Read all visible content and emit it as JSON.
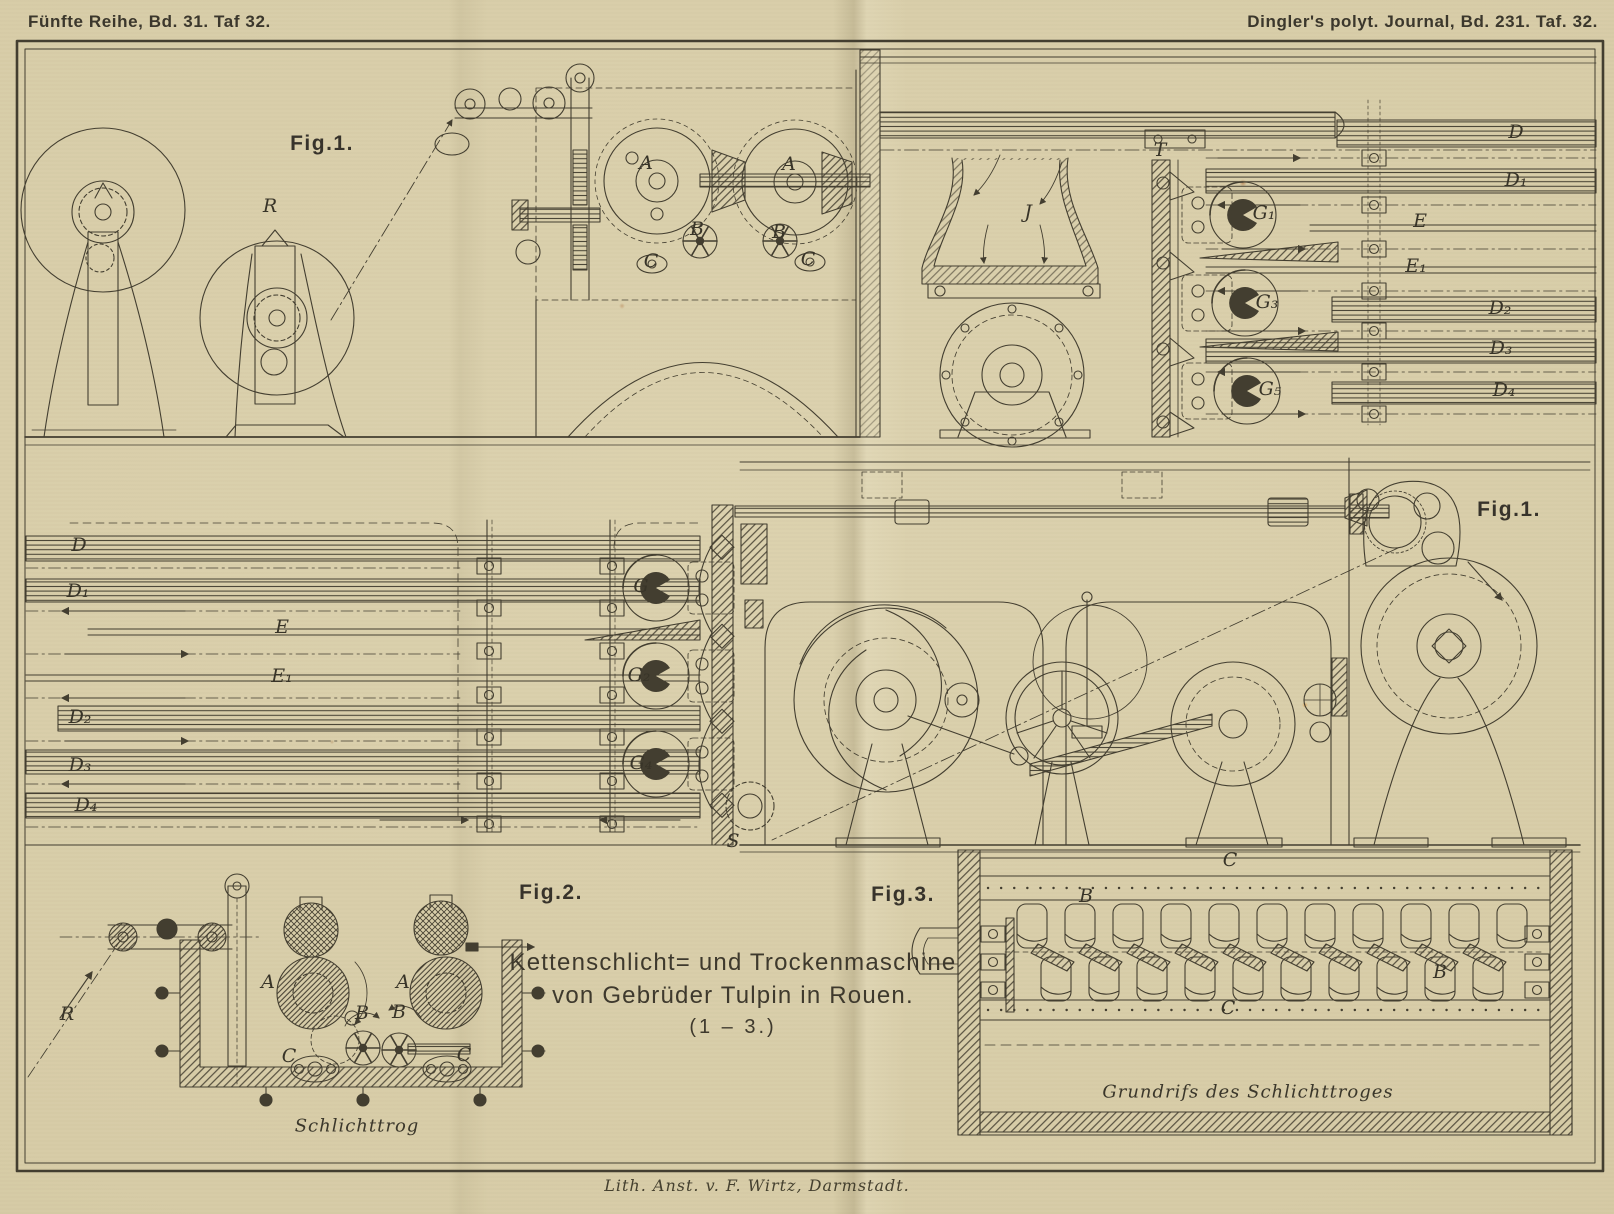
{
  "plate": {
    "header_left": "Fünfte Reihe, Bd. 31. Taf 32.",
    "header_right": "Dingler's polyt. Journal, Bd. 231. Taf. 32.",
    "footer": "Lith. Anst. v. F. Wirtz, Darmstadt.",
    "title": {
      "line1": "Kettenschlicht= und Trockenmaschine",
      "line2": "von Gebrüder Tulpin in Rouen.",
      "range": "(1 – 3.)"
    },
    "colors": {
      "paper": "#d7cca7",
      "paper_light": "#dcd2af",
      "paper_dark": "#cec29b",
      "ink": "#433e30",
      "ink_dark": "#37332b",
      "hatch": "#4a4435"
    }
  },
  "figure_labels": [
    {
      "text": "Fig.1.",
      "x": 322,
      "y": 144
    },
    {
      "text": "Fig.1.",
      "x": 1509,
      "y": 510
    },
    {
      "text": "Fig.2.",
      "x": 551,
      "y": 893
    },
    {
      "text": "Fig.3.",
      "x": 903,
      "y": 895
    }
  ],
  "captions": [
    {
      "text": "Schlichttrog",
      "x": 357,
      "y": 1126
    },
    {
      "text": "Grundrifs des Schlichttroges",
      "x": 1248,
      "y": 1092
    }
  ],
  "part_labels": [
    {
      "text": "R",
      "x": 270,
      "y": 206
    },
    {
      "text": "A",
      "x": 646,
      "y": 163
    },
    {
      "text": "A",
      "x": 789,
      "y": 164
    },
    {
      "text": "B",
      "x": 697,
      "y": 229
    },
    {
      "text": "B",
      "x": 779,
      "y": 232
    },
    {
      "text": "C",
      "x": 651,
      "y": 261
    },
    {
      "text": "C",
      "x": 808,
      "y": 259
    },
    {
      "text": "J",
      "x": 1028,
      "y": 212
    },
    {
      "text": "T",
      "x": 1160,
      "y": 150
    },
    {
      "text": "G₁",
      "x": 1264,
      "y": 213
    },
    {
      "text": "G₃",
      "x": 1267,
      "y": 302
    },
    {
      "text": "G₅",
      "x": 1270,
      "y": 389
    },
    {
      "text": "D",
      "x": 1516,
      "y": 132
    },
    {
      "text": "D₁",
      "x": 1516,
      "y": 180
    },
    {
      "text": "E",
      "x": 1420,
      "y": 221
    },
    {
      "text": "E₁",
      "x": 1416,
      "y": 266
    },
    {
      "text": "D₂",
      "x": 1500,
      "y": 308
    },
    {
      "text": "D₃",
      "x": 1501,
      "y": 348
    },
    {
      "text": "D₄",
      "x": 1504,
      "y": 390
    },
    {
      "text": "D",
      "x": 79,
      "y": 545
    },
    {
      "text": "D₁",
      "x": 78,
      "y": 591
    },
    {
      "text": "E",
      "x": 282,
      "y": 627
    },
    {
      "text": "E₁",
      "x": 282,
      "y": 676
    },
    {
      "text": "D₂",
      "x": 80,
      "y": 717
    },
    {
      "text": "D₃",
      "x": 80,
      "y": 765
    },
    {
      "text": "D₄",
      "x": 86,
      "y": 805
    },
    {
      "text": "G",
      "x": 641,
      "y": 586
    },
    {
      "text": "G₂",
      "x": 639,
      "y": 675
    },
    {
      "text": "G₄",
      "x": 641,
      "y": 763
    },
    {
      "text": "S",
      "x": 733,
      "y": 841
    },
    {
      "text": "R",
      "x": 67,
      "y": 1014
    },
    {
      "text": "A",
      "x": 268,
      "y": 982
    },
    {
      "text": "A",
      "x": 403,
      "y": 982
    },
    {
      "text": "B",
      "x": 362,
      "y": 1013
    },
    {
      "text": "B",
      "x": 399,
      "y": 1012
    },
    {
      "text": "C",
      "x": 289,
      "y": 1056
    },
    {
      "text": "C",
      "x": 464,
      "y": 1055
    },
    {
      "text": "C",
      "x": 1230,
      "y": 860
    },
    {
      "text": "B",
      "x": 1086,
      "y": 896
    },
    {
      "text": "B",
      "x": 1440,
      "y": 972
    },
    {
      "text": "C",
      "x": 1228,
      "y": 1008
    }
  ]
}
